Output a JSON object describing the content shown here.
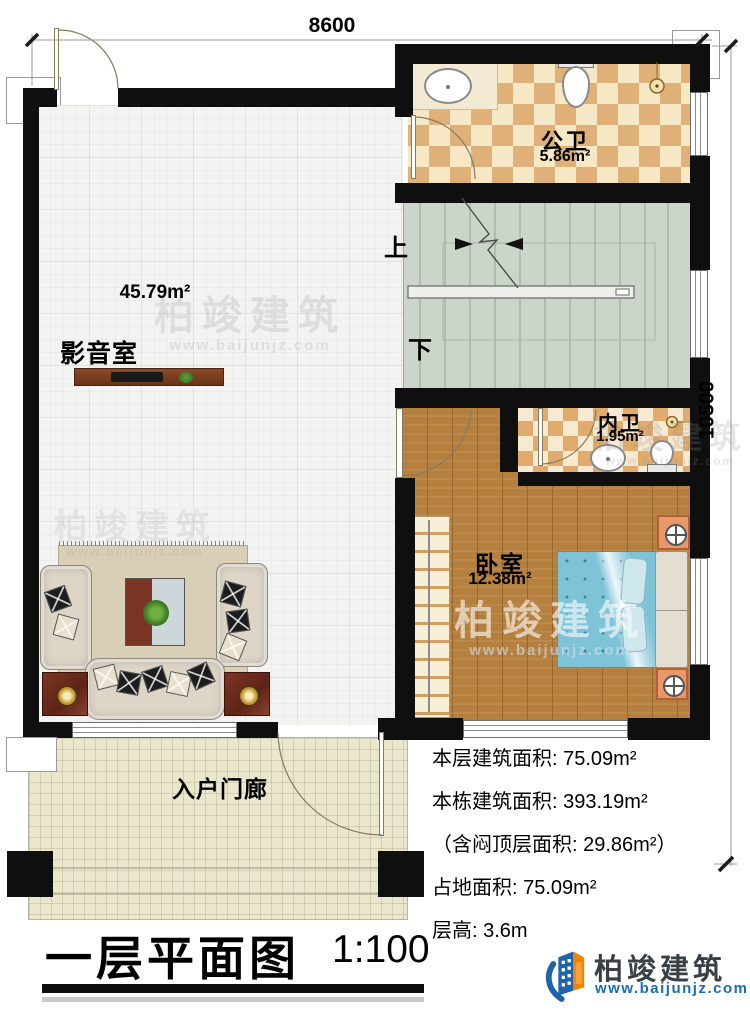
{
  "dimensions": {
    "top": "8600",
    "right": "10500"
  },
  "rooms": {
    "public_bath": {
      "name": "公卫",
      "area": "5.86m²"
    },
    "media_room": {
      "name": "影音室",
      "area": "45.79m²"
    },
    "inner_bath": {
      "name": "内卫",
      "area": "1.95m²"
    },
    "bedroom": {
      "name": "卧室",
      "area": "12.38m²"
    },
    "porch": {
      "name": "入户门廊"
    }
  },
  "stairs": {
    "up_label": "上",
    "down_label": "下"
  },
  "stats": {
    "floor_area": "本层建筑面积: 75.09m²",
    "total_area": "本栋建筑面积: 393.19m²",
    "attic_area": "（含闷顶层面积: 29.86m²）",
    "footprint": "占地面积: 75.09m²",
    "height": "层高: 3.6m"
  },
  "title": {
    "name": "一层平面图",
    "scale": "1:100"
  },
  "brand": {
    "name": "柏竣建筑",
    "url": "www.baijunjz.com"
  },
  "watermark": {
    "name": "柏竣建筑",
    "url": "www.baijunjz.com"
  },
  "colors": {
    "wall": "#0f0f0f",
    "tile_dark": "#e0b079",
    "tile_light": "#f6e8c4",
    "wood": "#b5803d",
    "stair": "#ccd5c9",
    "porch": "#ebe7cd",
    "bed": "#7fc3d8",
    "brand_blue": "#1a6cb8",
    "brand_orange": "#f08300"
  }
}
